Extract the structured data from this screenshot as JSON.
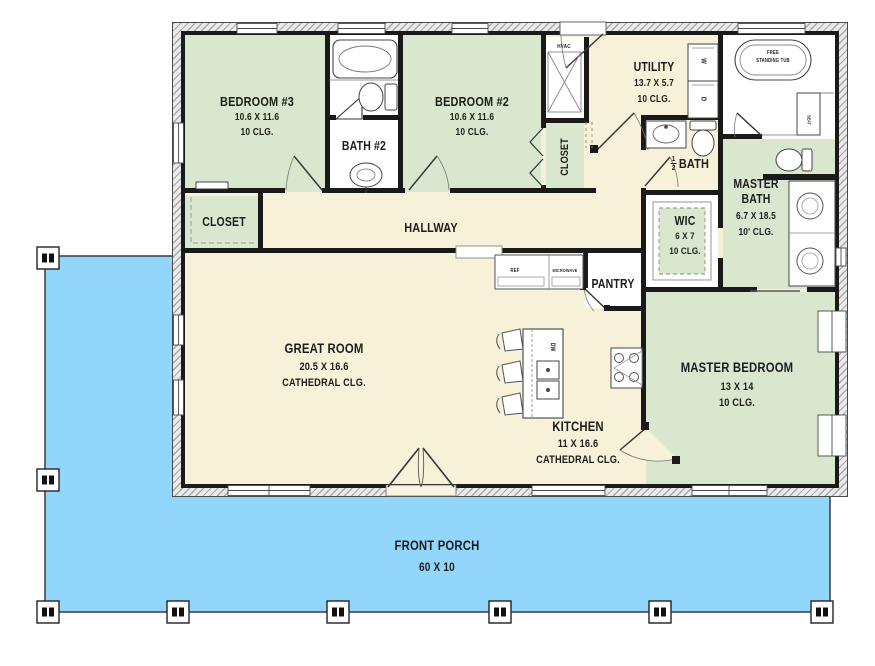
{
  "title": "single-story house floor plan",
  "rooms": {
    "bedroom3": {
      "name": "BEDROOM #3",
      "dims": "10.6 X 11.6",
      "clg": "10 CLG."
    },
    "bath2": {
      "name": "BATH #2"
    },
    "bedroom2": {
      "name": "BEDROOM #2",
      "dims": "10.6 X 11.6",
      "clg": "10 CLG."
    },
    "closet_bed2": {
      "name": "CLOSET"
    },
    "utility": {
      "name": "UTILITY",
      "dims": "13.7 X 5.7",
      "clg": "10 CLG."
    },
    "half_bath": {
      "num": "1",
      "den": "2",
      "name": "BATH"
    },
    "master_bath": {
      "name": "MASTER BATH",
      "dims": "6.7 X 18.5",
      "clg": "10' CLG."
    },
    "wic": {
      "name": "WIC",
      "dims": "6 X 7",
      "clg": "10 CLG."
    },
    "hallway": {
      "name": "HALLWAY"
    },
    "closet_hall": {
      "name": "CLOSET"
    },
    "great_room": {
      "name": "GREAT ROOM",
      "dims": "20.5 X 16.6",
      "clg": "CATHEDRAL CLG."
    },
    "kitchen": {
      "name": "KITCHEN",
      "dims": "11 X 16.6",
      "clg": "CATHEDRAL CLG."
    },
    "pantry": {
      "name": "PANTRY"
    },
    "master_bedroom": {
      "name": "MASTER BEDROOM",
      "dims": "13 X 14",
      "clg": "10 CLG."
    },
    "front_porch": {
      "name": "FRONT PORCH",
      "dims": "60 X 10"
    }
  },
  "fixtures": {
    "hvac": "HVAC",
    "ref": "REF",
    "microwave": "MICROWAVE",
    "dishwasher": "DW",
    "washer": "W",
    "dryer": "D",
    "free_tub": "FREE STANDING TUB",
    "seat": "SEAT"
  },
  "colors": {
    "porch": "#92d7fb",
    "room_green": "#d9e7ce",
    "room_cream": "#f6f1d8",
    "wall": "#1a1a1a"
  }
}
